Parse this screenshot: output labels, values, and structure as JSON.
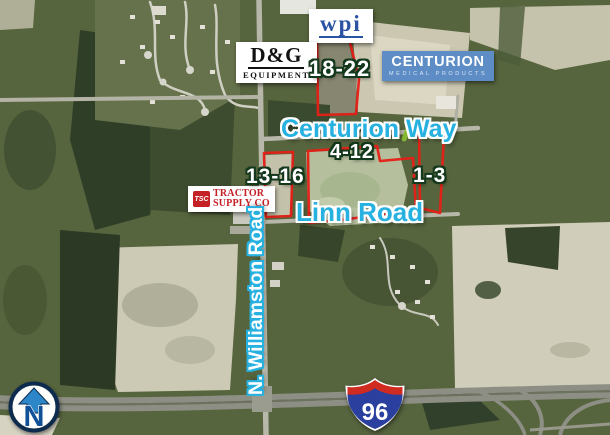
{
  "map": {
    "businesses": {
      "wpi": {
        "name": "wpi"
      },
      "dg": {
        "line1": "D&G",
        "line2": "EQUIPMENT"
      },
      "centurion": {
        "line1": "CENTURION",
        "line2": "MEDICAL PRODUCTS"
      },
      "tractor_supply": {
        "badge": "TSC",
        "line1": "TRACTOR",
        "line2": "SUPPLY CO"
      }
    },
    "lots": {
      "l18_22": "18-22",
      "l4_12": "4-12",
      "l13_16": "13-16",
      "l1_3": "1-3"
    },
    "roads": {
      "centurion_way": "Centurion Way",
      "linn_road": "Linn Road",
      "n_williamston": "N. Williamston Road"
    },
    "highway": {
      "route": "96"
    },
    "compass": {
      "north": "N"
    },
    "colors": {
      "parcel_outline_red": "#e71f17",
      "road_label_cyan": "#27b1e0",
      "lot_outline_green": "#14381c",
      "centurion_blue": "#5e8dc6",
      "tsc_red": "#c42127",
      "wpi_blue": "#2a53a4",
      "interstate_red": "#cf2b20",
      "interstate_blue": "#2b3f9f",
      "compass_navy": "#0d2b4d",
      "compass_blue": "#2c86c7"
    }
  }
}
